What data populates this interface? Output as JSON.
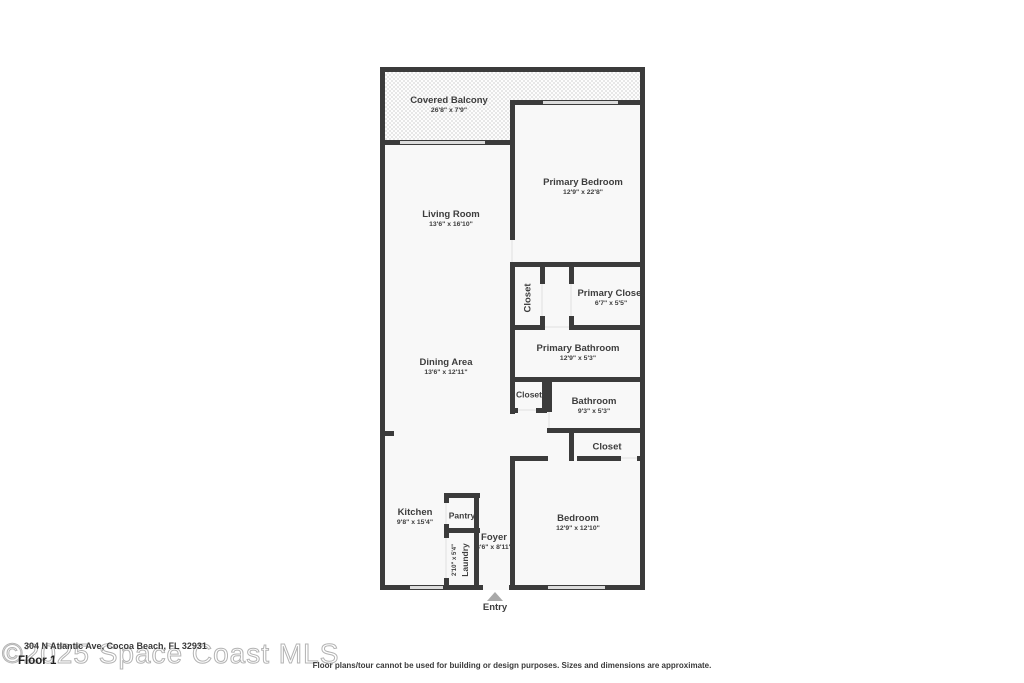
{
  "colors": {
    "wall": "#3b3b3b",
    "floor": "#f8f8f8",
    "window": "#dcdcdc",
    "label_text": "#3d3d3d",
    "entry_arrow": "#a9a9a9",
    "watermark": "#b3b3b3"
  },
  "rooms": {
    "covered_balcony": {
      "name": "Covered Balcony",
      "dims": "26'8\" x 7'9\""
    },
    "primary_bedroom": {
      "name": "Primary Bedroom",
      "dims": "12'9\" x 22'8\""
    },
    "living_room": {
      "name": "Living Room",
      "dims": "13'6\" x 16'10\""
    },
    "primary_hall_closet": {
      "name": "Closet"
    },
    "primary_closet": {
      "name": "Primary Closet",
      "dims": "6'7\" x 5'5\""
    },
    "primary_bathroom": {
      "name": "Primary Bathroom",
      "dims": "12'9\" x 5'3\""
    },
    "dining_area": {
      "name": "Dining Area",
      "dims": "13'6\" x 12'11\""
    },
    "hall_closet": {
      "name": "Closet"
    },
    "bathroom": {
      "name": "Bathroom",
      "dims": "9'3\" x 5'3\""
    },
    "bedroom_closet": {
      "name": "Closet"
    },
    "kitchen": {
      "name": "Kitchen",
      "dims": "9'8\" x 15'4\""
    },
    "pantry": {
      "name": "Pantry"
    },
    "laundry": {
      "name": "Laundry",
      "dims": "2'10\" x 5'4\""
    },
    "foyer": {
      "name": "Foyer",
      "dims": "3'6\" x 8'11\""
    },
    "bedroom": {
      "name": "Bedroom",
      "dims": "12'9\" x 12'10\""
    }
  },
  "entry": {
    "label": "Entry"
  },
  "footer": {
    "watermark": "©2025 Space Coast MLS",
    "address": "304 N Atlantic Ave, Cocoa Beach, FL 32931",
    "floor_label": "Floor 1",
    "disclaimer": "Floor plans/tour cannot be used for building or design purposes. Sizes and dimensions are approximate."
  }
}
